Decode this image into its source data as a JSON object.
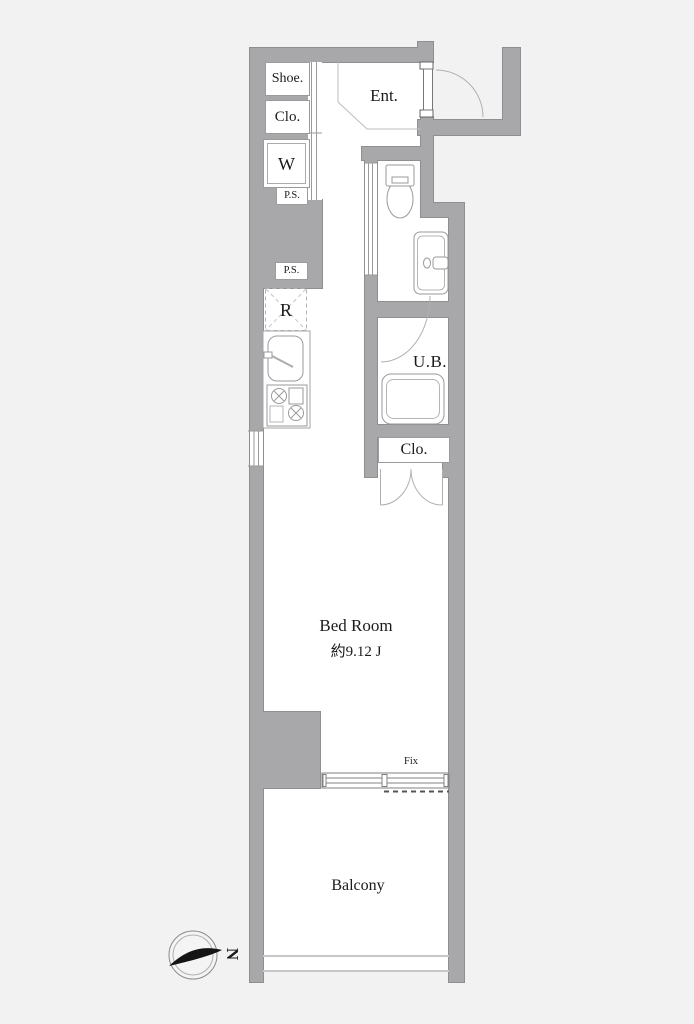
{
  "plan": {
    "labels": {
      "shoe": "Shoe.",
      "closet_upper": "Clo.",
      "washer": "W",
      "ps_upper": "P.S.",
      "ps_lower": "P.S.",
      "refrigerator": "R",
      "entrance": "Ent.",
      "unit_bath": "U.B.",
      "closet": "Clo.",
      "bedroom": "Bed Room",
      "bedroom_area": "約9.12 J",
      "fix_window": "Fix",
      "balcony": "Balcony",
      "compass_north": "N"
    },
    "colors": {
      "background": "#f2f2f3",
      "wall_fill": "#a8a8aa",
      "wall_edge": "#8f8f91",
      "floor": "#ffffff",
      "fixture_line": "#9a9a9a",
      "text": "#1b1b1b"
    }
  }
}
